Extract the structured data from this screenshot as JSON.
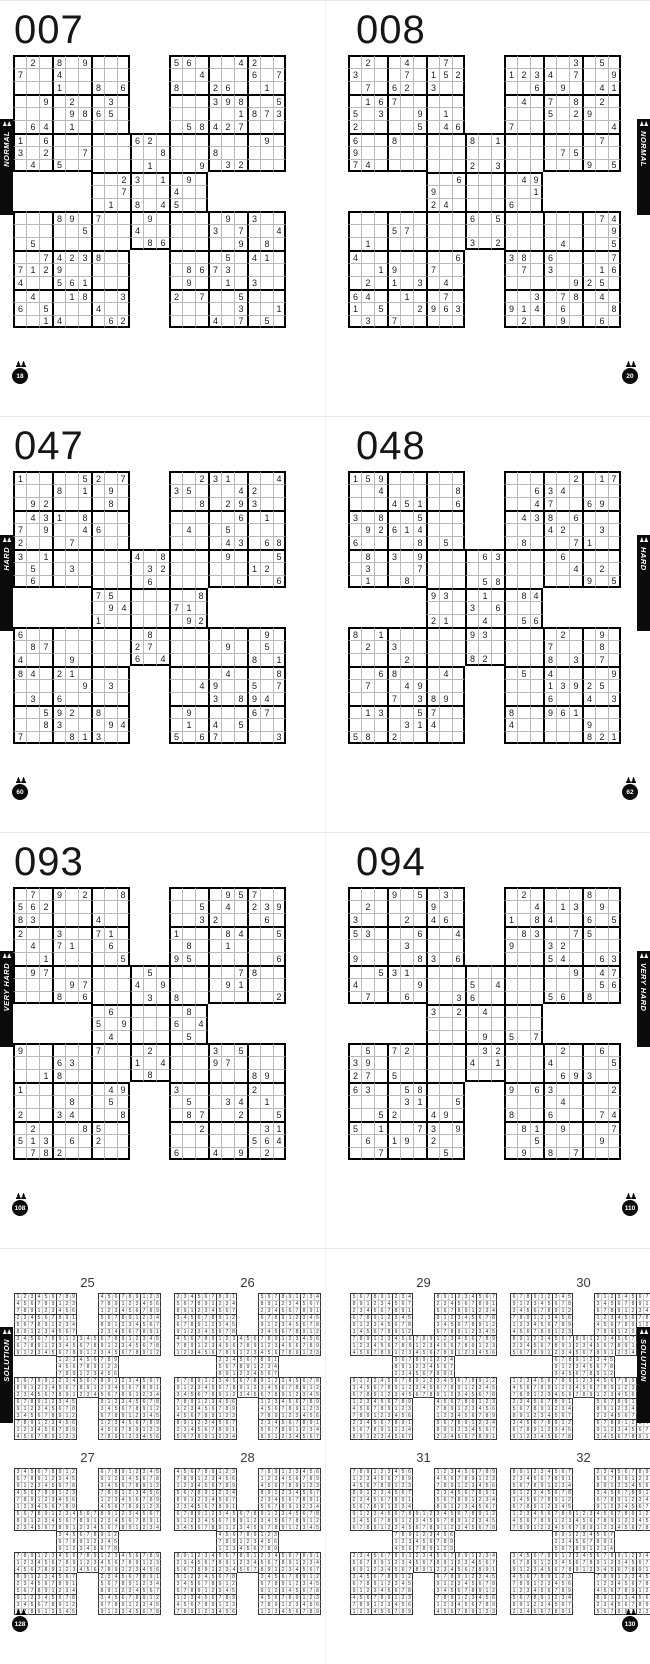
{
  "icons": {
    "pawns": "♟♟"
  },
  "spreads": [
    {
      "left": {
        "title": "007",
        "tab": "NORMAL",
        "badge": "18",
        "grids": {
          "tl": [
            ".2.8.9...",
            "7..4.....",
            "...1..8.6",
            "..9.2..3.",
            "....9865.",
            ".64.1....",
            "1.6......",
            "3.2..7...",
            ".4.5....."
          ],
          "tr": [
            "56...42..",
            "..4...6.7",
            "8..26..1.",
            "...398..5",
            ".....1873",
            ".58427...",
            ".......9.",
            "...8.....",
            "..9.32..."
          ],
          "c": [
            "...62....",
            ".....8...",
            "....1...9",
            "..23.1.9.",
            "..7...4..",
            ".1.8.45..",
            "7...9....",
            "...4.....",
            "....86..."
          ],
          "bl": [
            "...89.7..",
            ".....5...",
            ".5.......",
            "..74238..",
            "7129.....",
            "4..561...",
            ".4..18..3",
            "6.5...4..",
            "..14...62"
          ],
          "br": [
            "....9.3..",
            "...3.7..4",
            ".....9.8.",
            "....5.41.",
            ".8673....",
            ".9..1.3..",
            "2.7..5...",
            ".....3..1",
            "...4.7.5."
          ]
        }
      },
      "right": {
        "title": "008",
        "tab": "NORMAL",
        "badge": "20",
        "grids": {
          "tl": [
            ".2..4..7.",
            "3...7.152",
            ".7.62.3..",
            ".167.....",
            "5.3..9.1.",
            "2....5.46",
            "6..8.....",
            "9........",
            "74......."
          ],
          "tr": [
            ".....3.5.",
            "1234.7..9",
            "..6.9..41",
            ".4.7.8.2.",
            "...5.29..",
            "7.......4",
            ".......7.",
            "....75...",
            "......9.5"
          ],
          "c": [
            "...8.1...",
            ".........",
            "...2.3...",
            "..6....49",
            "9.......1",
            "24....6..",
            "...6.5...",
            ".........",
            "...3.2..."
          ],
          "bl": [
            ".........",
            "...57....",
            ".1.......",
            "4.......6",
            "..19..7..",
            ".2.1.3.4.",
            "64..1..7.",
            "1.5..2963",
            ".3.7....."
          ],
          "br": [
            ".......74",
            "........9",
            "....4...5",
            "38.6....7",
            ".7.3...16",
            ".....925.",
            "..3.78.4.",
            "914.6...8",
            ".2..9..6."
          ]
        }
      }
    },
    {
      "left": {
        "title": "047",
        "tab": "HARD",
        "badge": "60",
        "grids": {
          "tl": [
            "1....52.7",
            "...8.1.9.",
            ".92....8.",
            ".431.8...",
            "7.9..46..",
            "2...7....",
            "3.1......",
            ".5..3....",
            ".6......."
          ],
          "tr": [
            "..231...4",
            "35...42..",
            "..8.293..",
            ".....6.1.",
            ".4..5....",
            "....43.68",
            "....9...5",
            "......12.",
            "........6"
          ],
          "c": [
            "...4.8...",
            "....32...",
            "....6....",
            "75......8",
            ".94...71.",
            "1......92",
            "....8....",
            "...27....",
            "...6.4..."
          ],
          "bl": [
            "6........",
            ".87......",
            "4...9....",
            "84.21....",
            ".....9.3.",
            ".3.6.....",
            "..592.8..",
            "..83...94",
            "7...813.."
          ],
          "br": [
            ".......9.",
            "....9..5.",
            "......8.1",
            "....4...8",
            "..49..5.7",
            "...3.894.",
            ".9....67.",
            ".1.4.5...",
            "5.67....3"
          ]
        }
      },
      "right": {
        "title": "048",
        "tab": "HARD",
        "badge": "62",
        "grids": {
          "tl": [
            "159......",
            "..4.....8",
            "...451..6",
            "3.8..5...",
            ".92614...",
            "6....8.5.",
            ".8.3.9...",
            ".3...7...",
            ".1..8...."
          ],
          "tr": [
            ".....2.17",
            "..634....",
            "..47..69.",
            ".438.6...",
            "...42..3.",
            ".8...71..",
            "....6....",
            ".....4.2.",
            "......9.5"
          ],
          "c": [
            "....63...",
            ".........",
            "....58...",
            "93..1..84",
            "...3.6...",
            "21..4..56",
            "...93....",
            ".........",
            "...82...."
          ],
          "bl": [
            "8.1......",
            ".2.3.....",
            "....2....",
            "..68...4.",
            ".7..49...",
            "...7.389.",
            ".13..57..",
            "....314..",
            "58.2....."
          ],
          "br": [
            "....2..9.",
            "...7...8.",
            "...8.3.7.",
            ".5.4....9",
            "...13925.",
            "...6..4.3",
            "8..961...",
            "4.....9..",
            "......821"
          ]
        }
      }
    },
    {
      "left": {
        "title": "093",
        "tab": "VERY HARD",
        "badge": "108",
        "grids": {
          "tl": [
            ".7.9.2..8",
            "562......",
            "83....4..",
            "2..3..71.",
            ".4.71..6.",
            "..1.....5",
            ".97......",
            "....97...",
            "...8.6..."
          ],
          "tr": [
            "....957..",
            "..5.4.239",
            "..32...6.",
            "1...84..5",
            ".8..1....",
            "95......6",
            ".....78..",
            "....91...",
            "8.......2"
          ],
          "c": [
            "....5....",
            "...4.9...",
            "....3.8..",
            ".6.....8.",
            "5.9...6.4",
            ".4.....5.",
            "7...2....",
            "...1.4...",
            "....8...."
          ],
          "bl": [
            "9.....7..",
            "...63....",
            "..18.....",
            "1......49",
            "....8..5.",
            "2..34...8",
            ".2...85..",
            "513.6.2..",
            ".782....."
          ],
          "br": [
            "...3.5...",
            "...97....",
            "......89.",
            "3.....2..",
            ".5..34.1.",
            ".87..2..5",
            "..2....31",
            "......564",
            "6..4.9.2."
          ]
        }
      },
      "right": {
        "title": "094",
        "tab": "VERY HARD",
        "badge": "110",
        "grids": {
          "tl": [
            "...9.5.3.",
            ".2....9..",
            "3...2.46.",
            "53...6..4",
            "....3....",
            "9....83.6",
            "..531....",
            "4....9...",
            ".7..6...3"
          ],
          "tr": [
            ".2....8..",
            "..4.13.9.",
            "1.84..6.5",
            ".83..75..",
            "9..32....",
            "...54..63",
            ".....9.47",
            ".......56",
            "...56.8.."
          ],
          "c": [
            ".........",
            "...5.4...",
            "..36.....",
            "3.2.4....",
            ".........",
            "....9.5.7",
            "....32...",
            "...4.1...",
            "........."
          ],
          "bl": [
            ".5.72....",
            "39.......",
            "27.5.....",
            "63..58...",
            "....31..5",
            "..52..49.",
            "5.1..73.9",
            ".6.19.2..",
            "..7....5."
          ],
          "br": [
            "....2..6.",
            "...4....5",
            "....693..",
            "9.63....2",
            "....4....",
            "8..6...74",
            ".81.9...7",
            "..5....9.",
            ".9.8.7..."
          ]
        }
      }
    },
    {
      "left": {
        "title": "",
        "tab": "SOLUTION",
        "badge": "128",
        "labels": [
          "25",
          "26",
          "27",
          "28"
        ],
        "offsets": [
          0,
          1,
          2,
          3
        ]
      },
      "right": {
        "title": "",
        "tab": "SOLUTION",
        "badge": "130",
        "labels": [
          "29",
          "30",
          "31",
          "32"
        ],
        "offsets": [
          4,
          5,
          6,
          7
        ]
      }
    }
  ],
  "solution_base_rows": [
    "123456789   456789123",
    "456789123   789123456",
    "789123456   123456789",
    "234567891   567891234",
    "567891234   891234567",
    "891234567   234567891",
    "345678912345678912345",
    "678912345678912345678",
    "912345678912345678912",
    "      123456789      ",
    "      456789123      ",
    "      789123456      ",
    "567891234567891234567",
    "891234567891234567891",
    "234567891234567891234",
    "678912345   912345678",
    "912345678   345678912",
    "345678912   678912345",
    "789123456   123456789",
    "123456789   456789123",
    "456789123   789123456"
  ]
}
